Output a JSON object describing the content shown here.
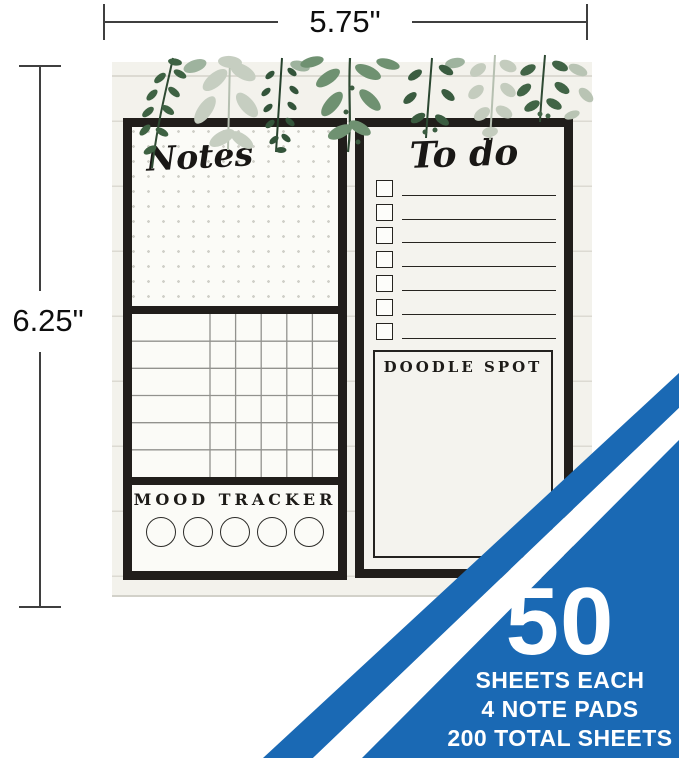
{
  "dimensions": {
    "width_label": "5.75\"",
    "height_label": "6.25\""
  },
  "pad": {
    "notes": {
      "title": "Notes"
    },
    "grid": {
      "rows": 6,
      "narrow_cols": 5
    },
    "mood": {
      "title": "MOOD TRACKER",
      "circles": 5
    },
    "todo": {
      "title": "To do",
      "rows": 7
    },
    "doodle": {
      "title": "DOODLE SPOT"
    }
  },
  "badge": {
    "big_number": "50",
    "lines": [
      "SHEETS EACH",
      "4 NOTE PADS",
      "200 TOTAL SHEETS"
    ]
  },
  "colors": {
    "banner_blue": "#1a69b4",
    "frame_black": "#211e1b",
    "pad_cream": "#f3f2ec",
    "leaf_dark_green": "#3a5c3f",
    "leaf_mid_green": "#6f9171",
    "leaf_pale_sage": "#c5cdc0"
  }
}
